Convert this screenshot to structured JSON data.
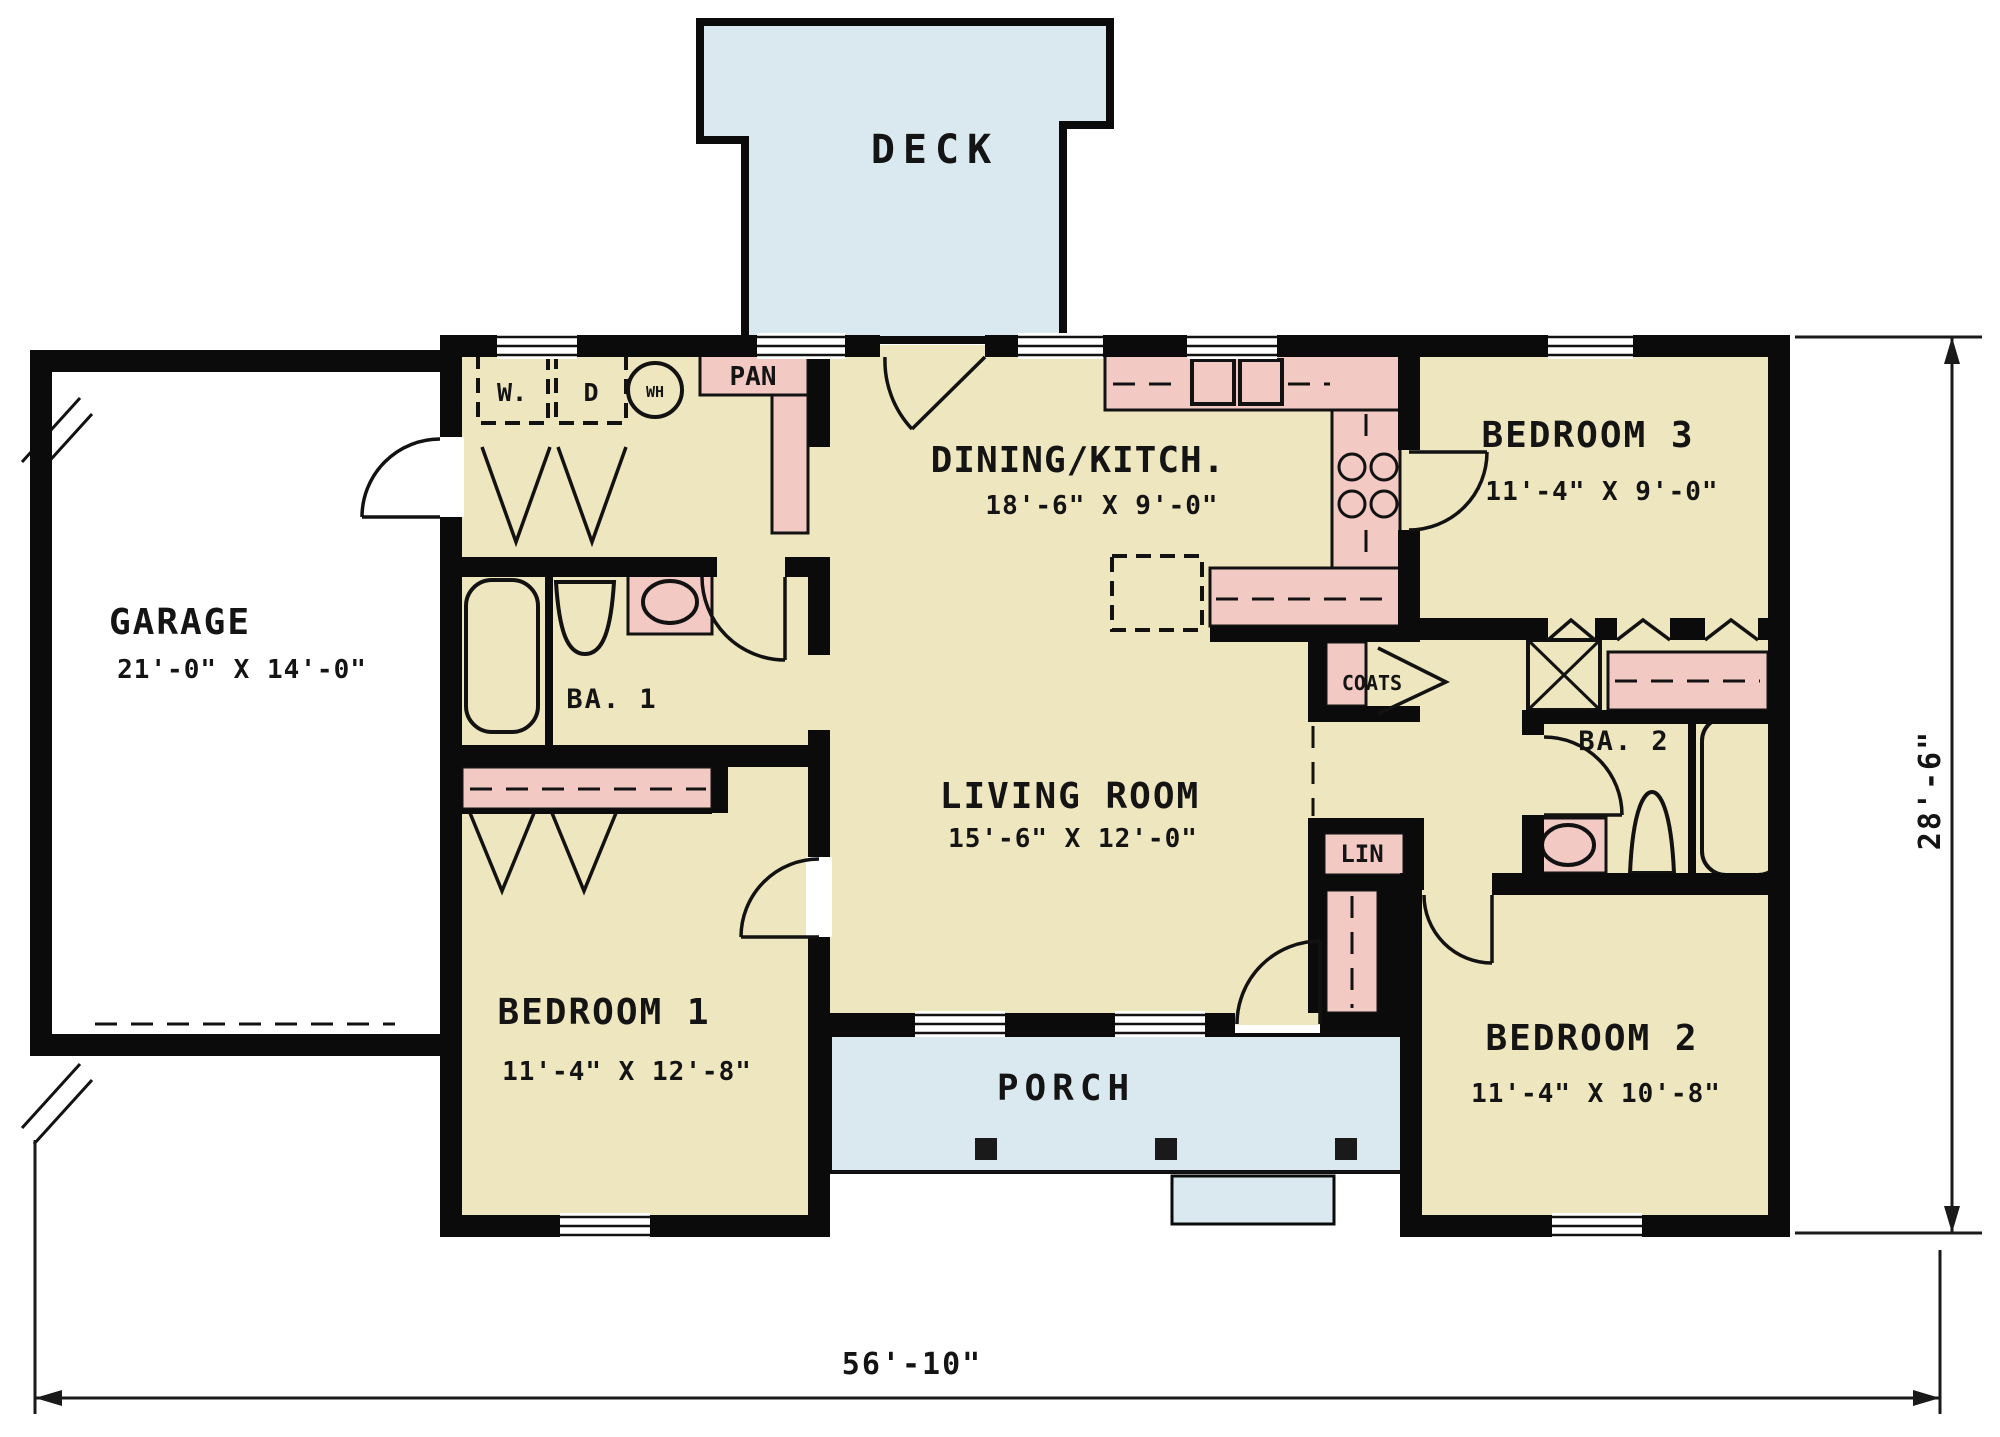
{
  "plan": {
    "title": "Ranch house first floor plan",
    "colors": {
      "floor": "#EDE6BE",
      "closet": "#F3C9C4",
      "outdoor": "#D9E9EF",
      "wall": "#0B0B0B",
      "ink": "#141414",
      "background": "#FFFFFF"
    },
    "rooms": {
      "deck": {
        "label": "DECK"
      },
      "garage": {
        "label": "GARAGE",
        "dims": "21'-0\" X 14'-0\""
      },
      "dining_kitchen": {
        "label": "DINING/KITCH.",
        "dims": "18'-6\" X 9'-0\""
      },
      "bedroom3": {
        "label": "BEDROOM 3",
        "dims": "11'-4\" X 9'-0\""
      },
      "bath1": {
        "label": "BA. 1"
      },
      "living_room": {
        "label": "LIVING ROOM",
        "dims": "15'-6\" X 12'-0\""
      },
      "bath2": {
        "label": "BA. 2"
      },
      "bedroom1": {
        "label": "BEDROOM 1",
        "dims": "11'-4\" X 12'-8\""
      },
      "bedroom2": {
        "label": "BEDROOM 2",
        "dims": "11'-4\" X 10'-8\""
      },
      "porch": {
        "label": "PORCH"
      }
    },
    "closets": {
      "pantry": "PAN",
      "coats": "COATS",
      "linen": "LIN"
    },
    "appliances": {
      "washer": "W.",
      "dryer": "D",
      "water_heater": "WH"
    },
    "overall_dimensions": {
      "width": "56'-10\"",
      "depth": "28'-6\""
    }
  }
}
